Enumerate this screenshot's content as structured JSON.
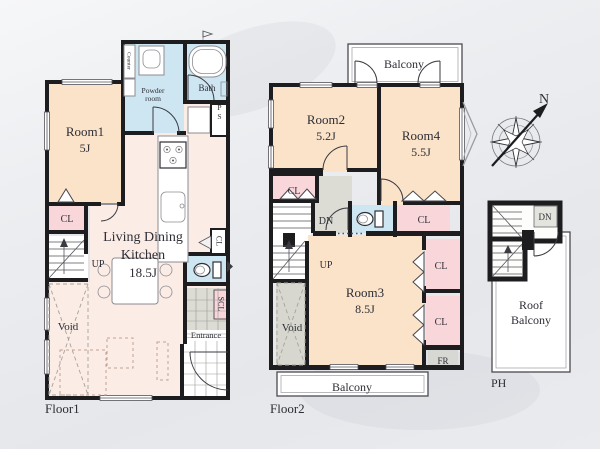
{
  "colors": {
    "wall": "#1d1d20",
    "room_fill": "#fbe3c9",
    "ldk_fill": "#fbece6",
    "closet_fill": "#f8d6da",
    "water_fill": "#cde6f1",
    "gray_fill": "#dcdcd5",
    "void_gray": "#d7d7d0",
    "background": "#e9ebee"
  },
  "floor1": {
    "label": "Floor1",
    "room1": {
      "name": "Room1",
      "size": "5J"
    },
    "ldk": {
      "line1": "Living Dining",
      "line2": "Kitchen",
      "size": "18.5J"
    },
    "powder_room": {
      "line1": "Powder",
      "line2": "room"
    },
    "bath": "Bath",
    "counter": "Counter",
    "ps": "PS",
    "closet": "CL",
    "closet_hall": "CL",
    "scl": "SCL",
    "up": "UP",
    "void": "Void",
    "entrance": "Entrance"
  },
  "floor2": {
    "label": "Floor2",
    "balcony_top": "Balcony",
    "balcony_bottom": "Balcony",
    "room2": {
      "name": "Room2",
      "size": "5.2J"
    },
    "room4": {
      "name": "Room4",
      "size": "5.5J"
    },
    "room3": {
      "name": "Room3",
      "size": "8.5J"
    },
    "closet_room2": "CL",
    "closet_hall": "CL",
    "closet_room3_upper": "CL",
    "closet_room3_lower": "CL",
    "dn": "DN",
    "up": "UP",
    "void": "Void",
    "fr": "FR"
  },
  "penthouse": {
    "label": "PH",
    "dn": "DN",
    "roof_balcony": {
      "line1": "Roof",
      "line2": "Balcony"
    }
  },
  "compass": {
    "north": "N"
  }
}
